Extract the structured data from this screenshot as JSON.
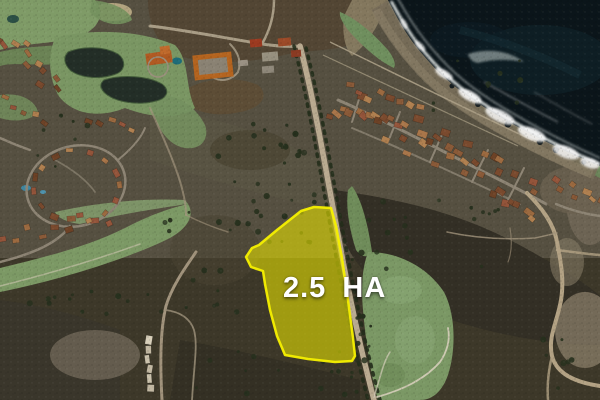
{
  "overlay": {
    "area_label": "2.5 HA"
  },
  "colors": {
    "parcel_fill": "#E8E400",
    "parcel_border": "#F6F000",
    "area_label_text": "#FFFFFF",
    "ocean": "#0B151A",
    "surf_foam": "#EDF2F0",
    "fairway_green": "#7B9865",
    "scrub_brown": "#565041",
    "scrub_dark": "#353126",
    "shoreline": "#776D58",
    "main_road": "#B9AA90",
    "residential_road": "#8D8474",
    "dirt_road": "#B3A284",
    "roof_brown": "#8A5A38",
    "resort_roof_orange": "#B4641F",
    "pond": "#232E27"
  }
}
